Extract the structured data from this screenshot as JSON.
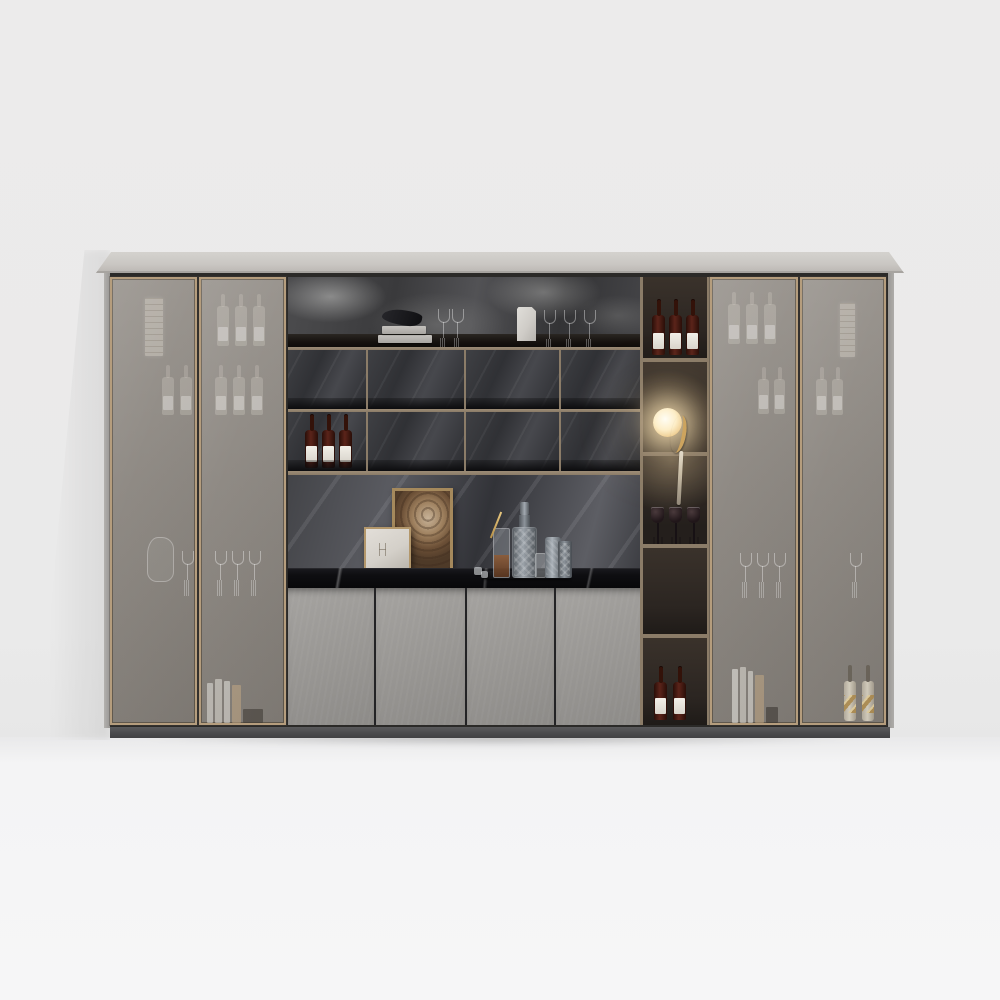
{
  "meta": {
    "scene_description": "Studio 3D render of a wide modern bar display cabinet with smoked-glass doors, dark marble open shelving, brass trim, gray lower doors and a lit display niche",
    "background": "plain light gray wall and white floor, soft shadows"
  },
  "colors": {
    "wall": "#ebebeb",
    "floor": "#f4f4f5",
    "slab": "#c9c6c2",
    "bronze": "#8b7c68",
    "bronze-light": "#b59d7d",
    "glass-hi": "#98938d",
    "glass-lo": "#837e78",
    "gray-door": "#989693",
    "plinth": "#4b4b4d",
    "counter": "#0e0e11",
    "niche-back": "#2b2521",
    "bottle-label": "#d9d5cc",
    "lamp-glow": "#ffe8b9",
    "gold": "#cda45e"
  },
  "cabinet": {
    "top": "light gray stone slab",
    "base": "dark gray plinth",
    "left_wing": {
      "doors": 2,
      "style": "smoked glass with brass frames",
      "behind_glass": [
        "vertical hanging label",
        "faint wine bottles",
        "faint wine glasses",
        "decanter silhouette",
        "stack of books"
      ]
    },
    "right_wing": {
      "doors": 2,
      "style": "smoked glass with brass frames",
      "behind_glass": [
        "faint wine bottles",
        "faint wine glasses",
        "vertical hanging label",
        "books",
        "two gold-striped bottles"
      ]
    },
    "center": {
      "top_shelf_items": [
        "stacked books with dark bird sculpture",
        "two wine glasses",
        "white paper bag",
        "three wine glasses"
      ],
      "cubby_rows": 2,
      "cubbies_per_row": 4,
      "cubby_contents": [
        "three red wine bottles with white labels in lower-left cubby"
      ],
      "display_items": [
        "large gold-framed wood artwork",
        "small gold-framed print",
        "crystal decanter",
        "highball glass with gold straw",
        "cocktail shaker",
        "patterned glass",
        "small glass",
        "ice cubes",
        "black tray"
      ],
      "lower_doors": 4,
      "lower_door_finish": "matte concrete gray"
    },
    "niche_column": {
      "compartments": 5,
      "contents": [
        "three wine bottles with white labels",
        "glowing sphere lamp held by brass figurine",
        "three dark wine glasses",
        "empty",
        "two wine bottles with white labels"
      ]
    }
  }
}
